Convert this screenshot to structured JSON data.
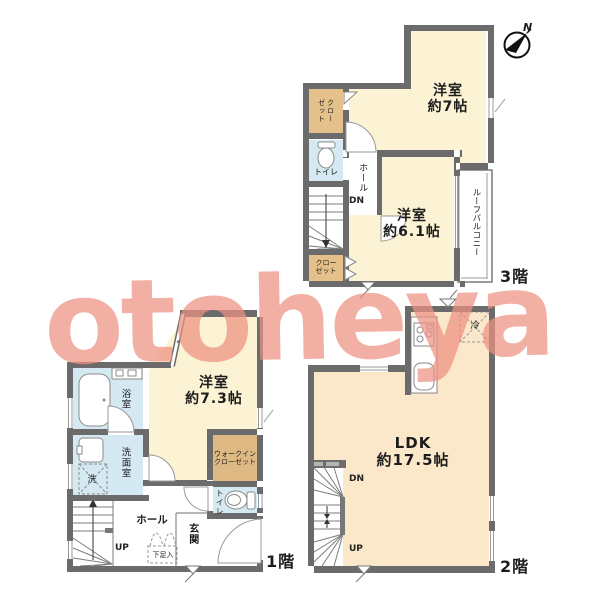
{
  "watermark": {
    "text": "otoheya"
  },
  "compass": {
    "north_label": "N"
  },
  "floor3": {
    "floor_label": "3階",
    "bedroom7_name": "洋室",
    "bedroom7_size": "約7帖",
    "bedroom61_name": "洋室",
    "bedroom61_size": "約6.1帖",
    "closet_upper_line1": "クロー",
    "closet_upper_line2": "ゼット",
    "closet_lower_line1": "クロー",
    "closet_lower_line2": "ゼット",
    "toilet_label": "トイレ",
    "hall_label": "ホール",
    "stairs_down_label": "DN",
    "roof_balcony_label": "ルーフバルコニー"
  },
  "floor2": {
    "floor_label": "2階",
    "ldk_name": "LDK",
    "ldk_size": "約17.5帖",
    "fridge_label": "冷",
    "stairs_down_label": "DN",
    "stairs_up_label": "UP"
  },
  "floor1": {
    "floor_label": "1階",
    "bedroom73_name": "洋室",
    "bedroom73_size": "約7.3帖",
    "bath_label": "浴室",
    "washroom_label": "洗面室",
    "washer_label": "洗",
    "wic_line1": "ウォークイン",
    "wic_line2": "クローゼット",
    "toilet_label": "トイレ",
    "hall_label": "ホール",
    "entrance_label": "玄関",
    "shoe_cabinet_label": "下足入",
    "stairs_up_label": "UP"
  }
}
